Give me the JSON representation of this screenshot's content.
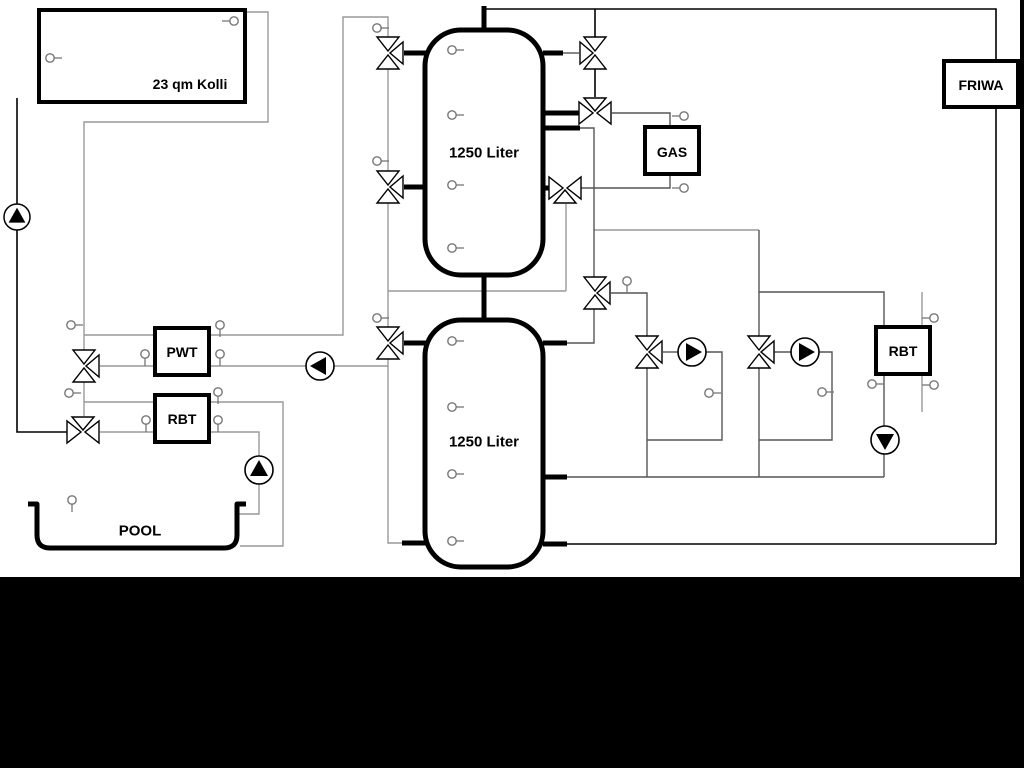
{
  "scene": {
    "background_color": "#000000",
    "surface_color": "#ffffff",
    "pipe_color_light": "#999999",
    "pipe_color_dark": "#555555",
    "line_color": "#000000"
  },
  "labels": {
    "collector": "23 qm Kolli",
    "buffer_tank_top": "1250 Liter",
    "buffer_tank_bottom": "1250 Liter",
    "gas_boiler": "GAS",
    "friwa_station": "FRIWA",
    "pwt_exchanger": "PWT",
    "rbt_pool_exchanger": "RBT",
    "rbt_right_exchanger": "RBT",
    "pool": "POOL"
  }
}
